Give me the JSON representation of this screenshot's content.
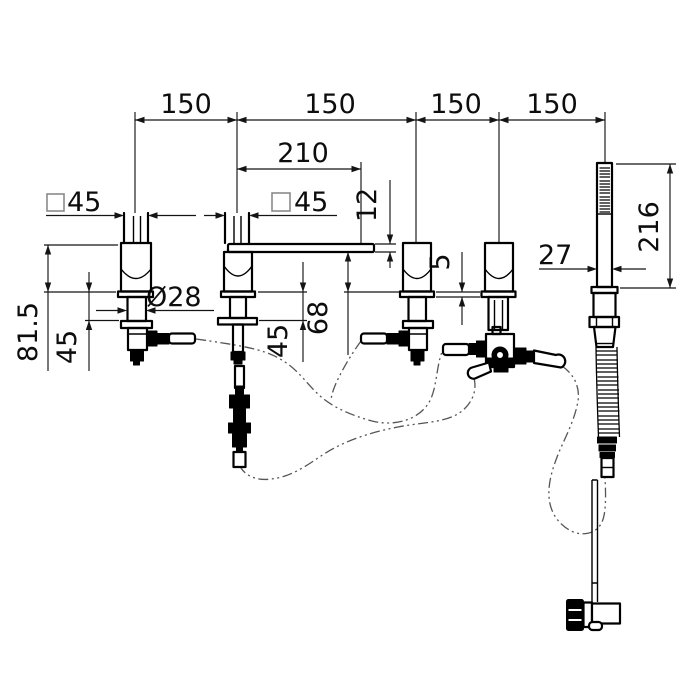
{
  "drawing": {
    "background": "#ffffff",
    "line_color": "#000000",
    "dimension_color": "#141414",
    "hose_style": "dash-dot"
  },
  "dims": {
    "span1": "150",
    "span2": "150",
    "span3": "150",
    "span4": "150",
    "spout_reach": "210",
    "spout_thickness": "12",
    "square_left": "45",
    "square_spout": "45",
    "stem_diameter": "Ø28",
    "body_height": "81.5",
    "under_deck_left": "45",
    "spout_outlet_height": "68",
    "under_deck_spout": "45",
    "flange_thickness": "5",
    "shower_grip_width": "27",
    "shower_length": "216"
  }
}
